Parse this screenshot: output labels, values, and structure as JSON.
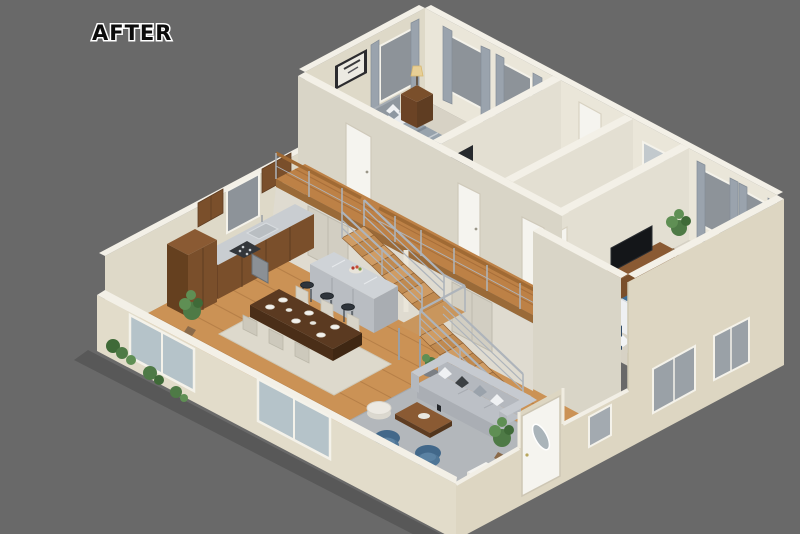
{
  "label": {
    "after": "AFTER"
  },
  "canvas": {
    "width": 800,
    "height": 534
  },
  "palette": {
    "background": "#696969",
    "wall_light": "#eae6d9",
    "wall_mid": "#ded9c8",
    "wall_shade": "#d9d5c7",
    "wall_cap": "#f3f0e7",
    "floor_wood": "#cb9255",
    "walkway_wood": "#bd8146",
    "carpet": "#d7d2c5",
    "tile": "#edeff0",
    "cabinet_wood": "#7a4f2b",
    "counter_gray": "#c9cdd1",
    "sofa_gray": "#bcc0c6",
    "rug_living": "#b3b7bb",
    "rug_dining": "#ddd9cc",
    "accent_blue": "#4e7596",
    "bed_blue": "#3f6e96",
    "curtain_gray": "#9aa3ad",
    "railing_metal": "#aeb4bb",
    "tread_wood": "#c9965d",
    "door_white": "#f5f4ef",
    "window_glass": "#8d9399",
    "plant_green": "#4e7a46",
    "lamp_shade": "#e7cf96"
  }
}
